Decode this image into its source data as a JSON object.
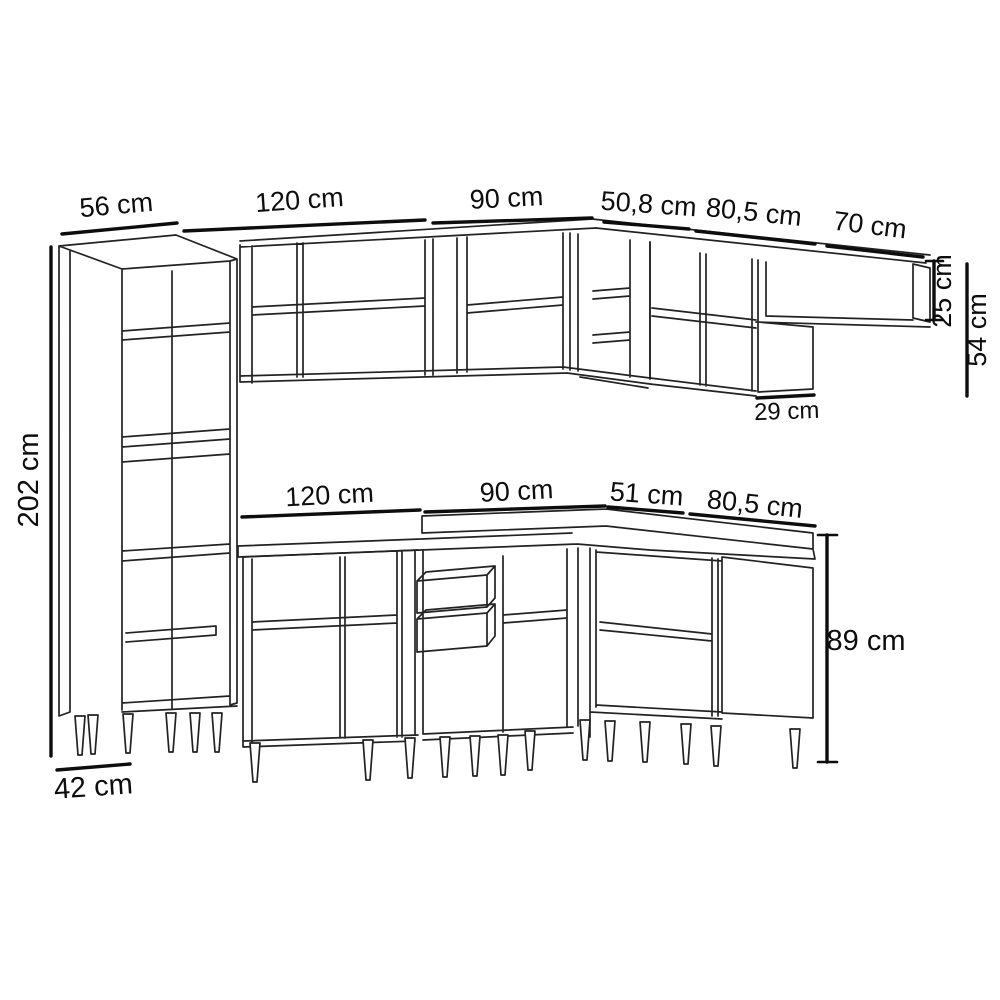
{
  "diagram": {
    "type": "furniture-dimension-line-drawing",
    "subject": "modular corner kitchen cabinet set, perspective view with dimension callouts",
    "colors": {
      "background": "#ffffff",
      "line": "#222222",
      "dimension_line": "#0d0d0d",
      "text": "#0d0d0d"
    },
    "dims": {
      "top": [
        {
          "name": "tall-cabinet-width",
          "label": "56 cm"
        },
        {
          "name": "wall-cabinet-120-width",
          "label": "120 cm"
        },
        {
          "name": "wall-cabinet-90-width",
          "label": "90 cm"
        },
        {
          "name": "corner-wall-cabinet-width",
          "label": "50,8 cm"
        },
        {
          "name": "wall-cabinet-805-width",
          "label": "80,5 cm"
        },
        {
          "name": "wall-shelf-width",
          "label": "70 cm"
        }
      ],
      "right": [
        {
          "name": "wall-shelf-height",
          "label": "25 cm"
        },
        {
          "name": "wall-cabinet-height",
          "label": "54 cm"
        },
        {
          "name": "wall-cabinet-depth",
          "label": "29 cm"
        }
      ],
      "left": {
        "name": "tall-cabinet-height",
        "label": "202 cm"
      },
      "bottom": {
        "name": "tall-cabinet-depth",
        "label": "42 cm"
      },
      "middle": [
        {
          "name": "base-cabinet-120-width",
          "label": "120 cm"
        },
        {
          "name": "base-corner-cabinet-width",
          "label": "90 cm"
        },
        {
          "name": "base-corner-side-width",
          "label": "51 cm"
        },
        {
          "name": "base-cabinet-805-width",
          "label": "80,5 cm"
        }
      ],
      "base_right": {
        "name": "base-cabinet-height",
        "label": "89 cm"
      }
    }
  }
}
